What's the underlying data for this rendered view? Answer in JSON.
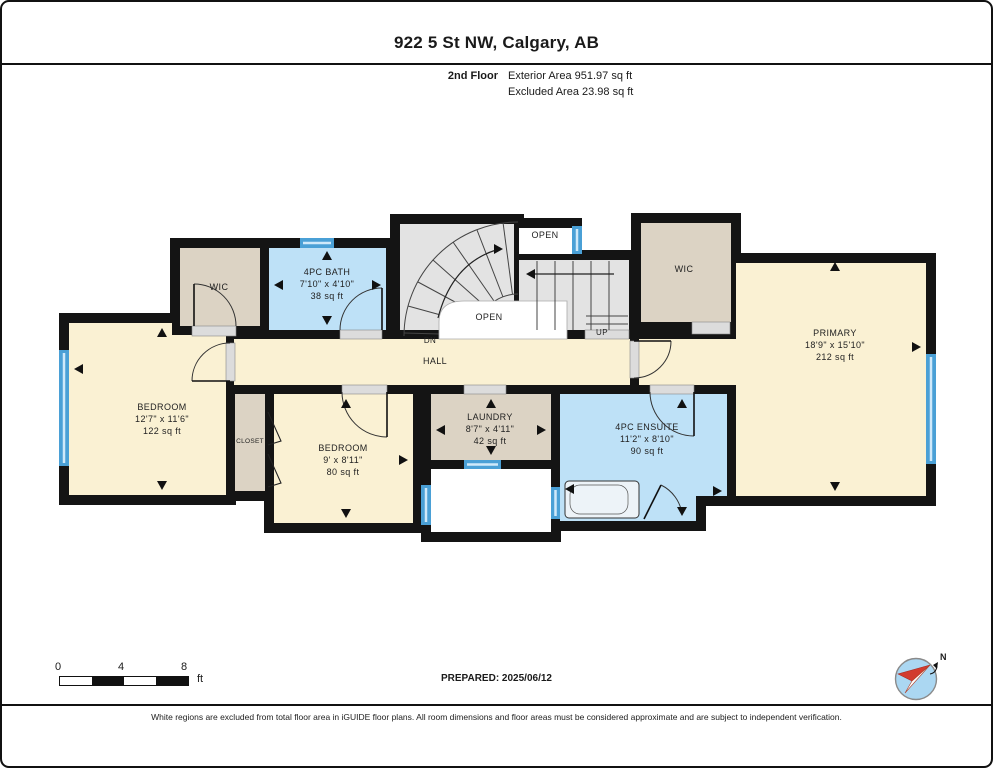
{
  "header": {
    "title": "922 5 St NW, Calgary, AB",
    "floor_label": "2nd Floor",
    "exterior_area": "Exterior Area 951.97 sq ft",
    "excluded_area": "Excluded Area 23.98 sq ft"
  },
  "rooms": {
    "wic_left": {
      "name": "WIC"
    },
    "bath": {
      "name": "4PC BATH",
      "dims": "7'10\" x 4'10\"",
      "area": "38 sq ft"
    },
    "open_top": {
      "name": "OPEN"
    },
    "open_stair": {
      "name": "OPEN"
    },
    "wic_right": {
      "name": "WIC"
    },
    "primary": {
      "name": "PRIMARY",
      "dims": "18'9\" x 15'10\"",
      "area": "212 sq ft"
    },
    "bedroom1": {
      "name": "BEDROOM",
      "dims": "12'7\" x 11'6\"",
      "area": "122 sq ft"
    },
    "closet": {
      "name": "CLOSET"
    },
    "bedroom2": {
      "name": "BEDROOM",
      "dims": "9' x 8'11\"",
      "area": "80 sq ft"
    },
    "laundry": {
      "name": "LAUNDRY",
      "dims": "8'7\" x 4'11\"",
      "area": "42 sq ft"
    },
    "ensuite": {
      "name": "4PC ENSUITE",
      "dims": "11'2\" x 8'10\"",
      "area": "90 sq ft"
    },
    "hall": {
      "name": "HALL"
    },
    "stairs": {
      "down": "DN",
      "up": "UP"
    }
  },
  "scale_bar": {
    "start": "0",
    "mid": "4",
    "end": "8",
    "unit": "ft"
  },
  "footer": {
    "prepared": "PREPARED: 2025/06/12",
    "disclaimer": "White regions are excluded from total floor area in iGUIDE floor plans. All room dimensions and floor areas must be considered approximate and are subject to independent verification."
  },
  "compass": {
    "north_label": "N"
  },
  "colors": {
    "wall": "#141414",
    "room_cream": "#FAF1D3",
    "room_tan": "#DCD3C4",
    "room_blue": "#BEE1F7",
    "stairs_gray": "#E3E3E3",
    "window_blue": "#4AA0D6",
    "compass_blue": "#ABD7F2",
    "compass_red": "#D23B2F"
  }
}
